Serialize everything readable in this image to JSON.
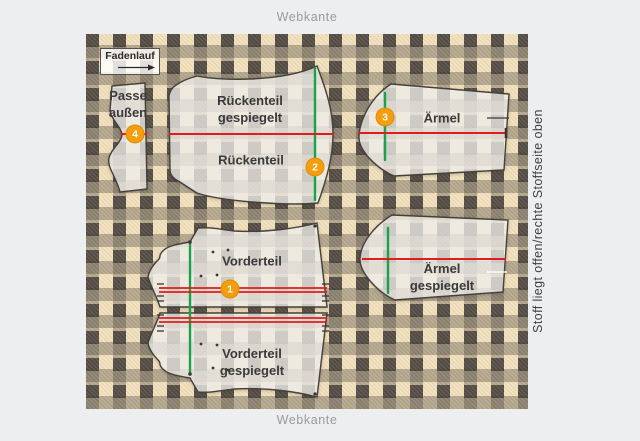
{
  "colors": {
    "pagebg": "#edeef0",
    "cream": "#f2e0bc",
    "band": "#3f3a35",
    "red": "#e01d1d",
    "green": "#18a24b",
    "orange": "#f59d0b",
    "label": "#3a3a3a",
    "muted": "#9b9b9b",
    "outline": "#44403a"
  },
  "frame": {
    "webkante_top": "Webkante",
    "webkante_bottom": "Webkante",
    "side_note": "Stoff liegt offen/rechte Stoffseite oben"
  },
  "grainline": {
    "label": "Fadenlauf"
  },
  "pieces": {
    "passe": {
      "label": "Passe außen"
    },
    "rueckenteil_gespiegelt": {
      "label": "Rückenteil gespiegelt"
    },
    "rueckenteil": {
      "label": "Rückenteil"
    },
    "aermel": {
      "label": "Ärmel"
    },
    "aermel_gespiegelt": {
      "label": "Ärmel gespiegelt"
    },
    "vorderteil": {
      "label": "Vorderteil"
    },
    "vorderteil_gespiegelt": {
      "label": "Vorderteil gespiegelt"
    }
  },
  "markers": {
    "m1": {
      "number": "1"
    },
    "m2": {
      "number": "2"
    },
    "m3": {
      "number": "3"
    },
    "m4": {
      "number": "4"
    }
  }
}
